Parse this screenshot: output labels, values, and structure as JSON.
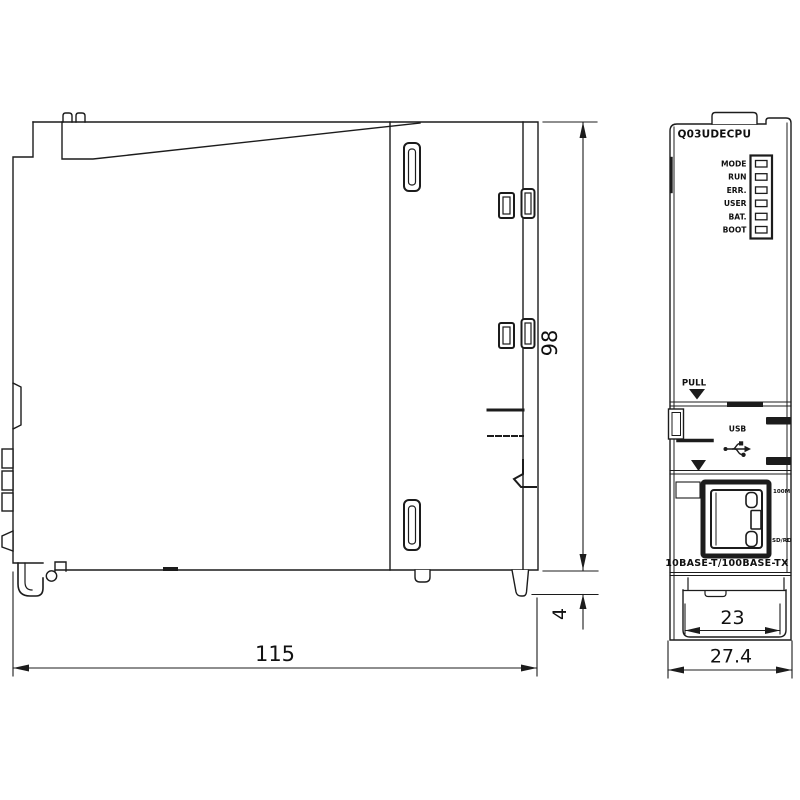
{
  "drawing": {
    "title": "CPU module external dimension drawing",
    "front": {
      "model_label": "Q03UDECPU",
      "led_labels": [
        "MODE",
        "RUN",
        "ERR.",
        "USER",
        "BAT.",
        "BOOT"
      ],
      "pull_label": "PULL",
      "usb_label": "USB",
      "port_led_top": "100M",
      "port_led_bottom": "SD/RD",
      "ethernet_caption": "10BASE-T/100BASE-TX"
    },
    "dimensions": {
      "depth": "115",
      "height": "98",
      "din_offset": "4",
      "inner_width": "23",
      "width": "27.4"
    },
    "colors": {
      "line": "#1c1c1c",
      "background": "#ffffff"
    },
    "icons": {
      "pull_arrow": "filled-down-triangle",
      "usb_arrow": "filled-down-triangle",
      "usb_symbol": "usb-trident",
      "ethernet_port": "rj45-socket"
    }
  }
}
